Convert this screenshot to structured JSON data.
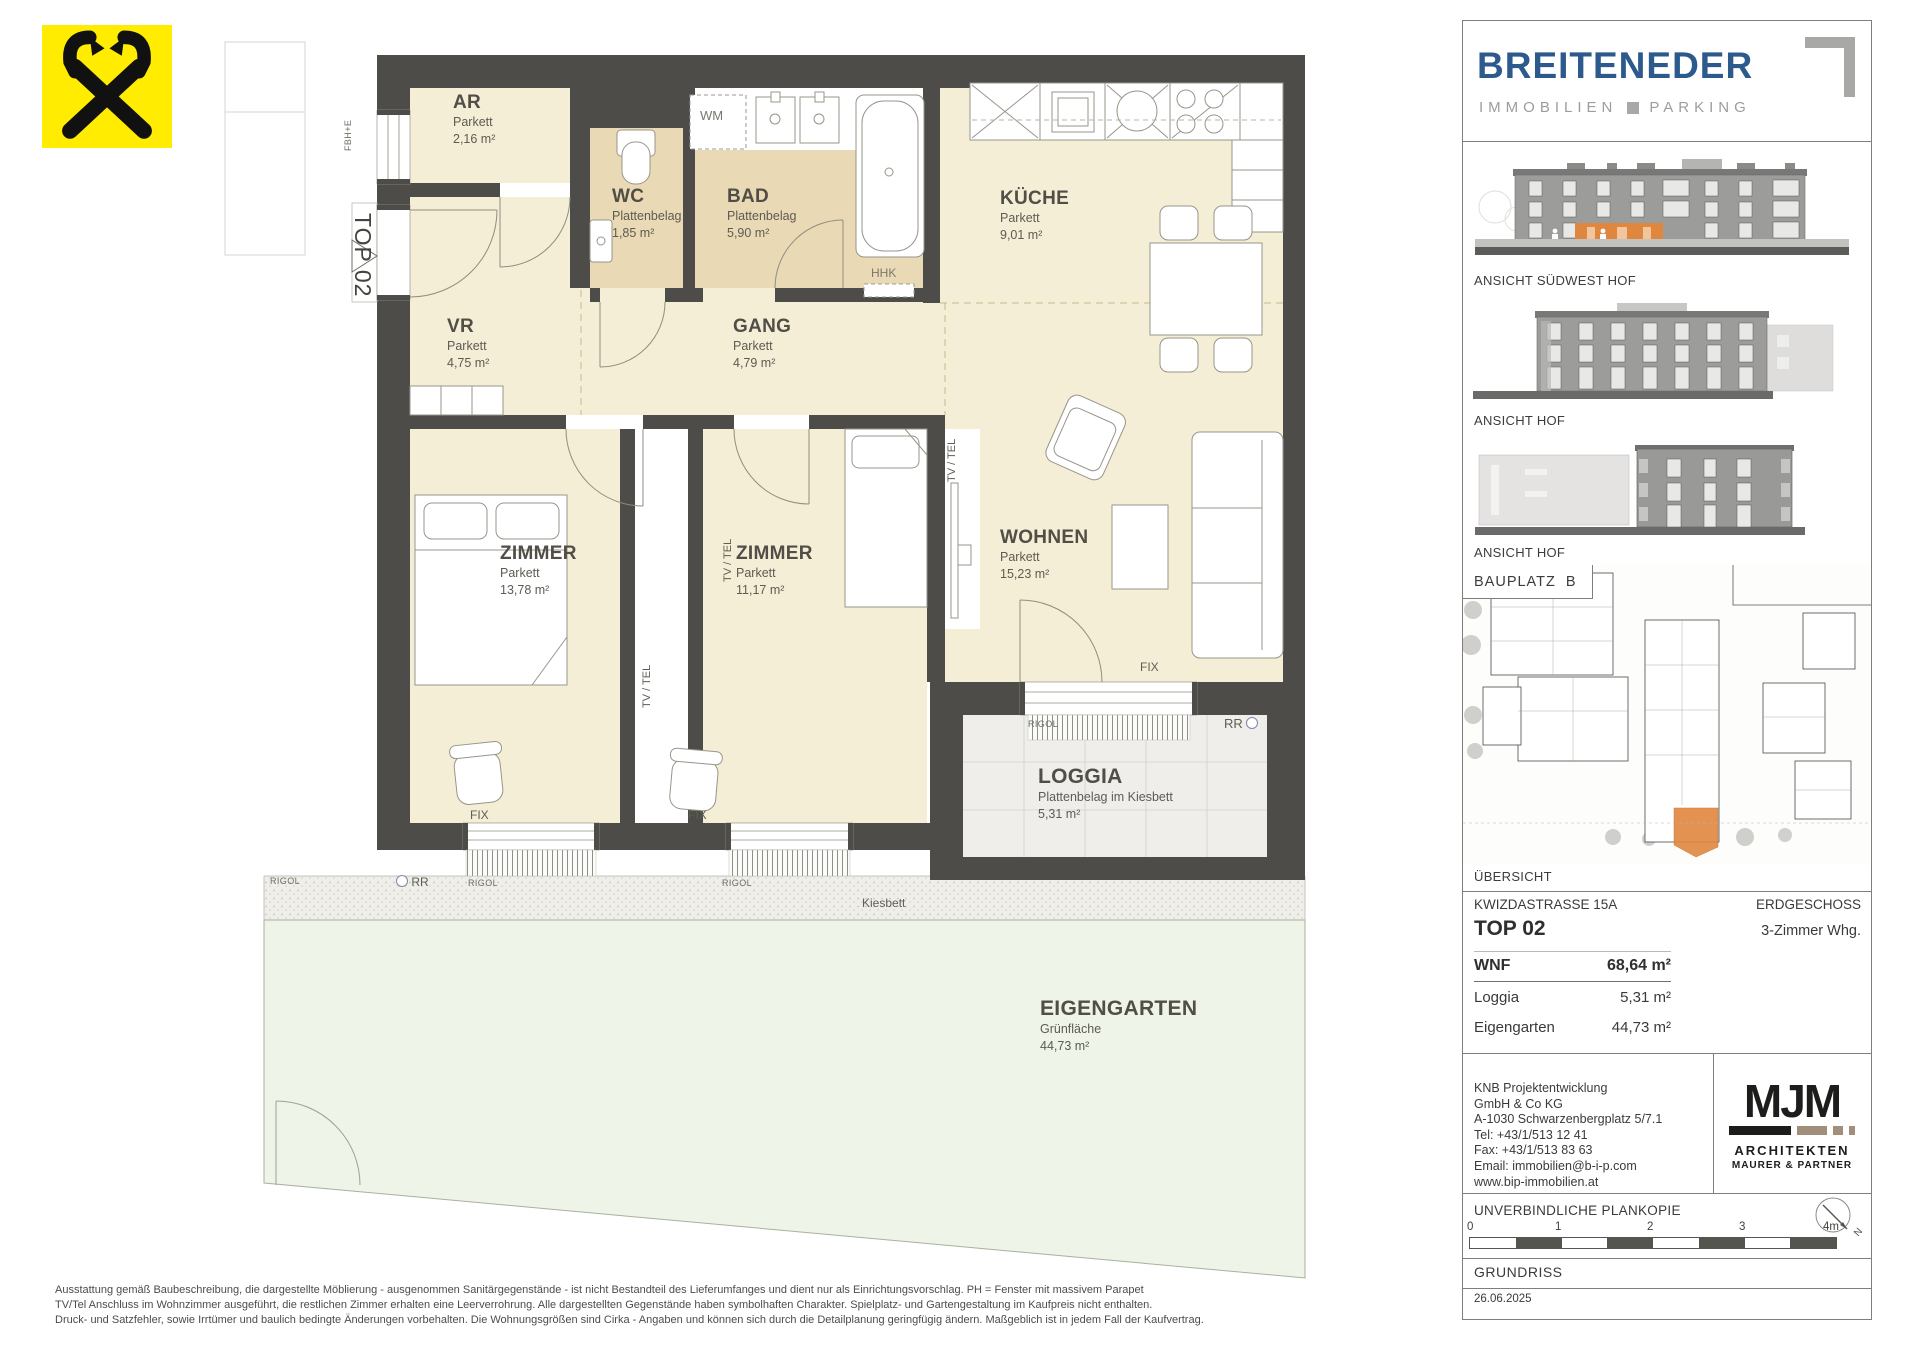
{
  "plan": {
    "unit_label": "TOP 02",
    "rooms": {
      "ar": {
        "name": "AR",
        "floor": "Parkett",
        "area": "2,16 m²"
      },
      "wc": {
        "name": "WC",
        "floor": "Plattenbelag",
        "area": "1,85 m²"
      },
      "bad": {
        "name": "BAD",
        "floor": "Plattenbelag",
        "area": "5,90 m²"
      },
      "kueche": {
        "name": "KÜCHE",
        "floor": "Parkett",
        "area": "9,01 m²"
      },
      "vr": {
        "name": "VR",
        "floor": "Parkett",
        "area": "4,75 m²"
      },
      "gang": {
        "name": "GANG",
        "floor": "Parkett",
        "area": "4,79 m²"
      },
      "zimmer1": {
        "name": "ZIMMER",
        "floor": "Parkett",
        "area": "13,78 m²"
      },
      "zimmer2": {
        "name": "ZIMMER",
        "floor": "Parkett",
        "area": "11,17 m²"
      },
      "wohnen": {
        "name": "WOHNEN",
        "floor": "Parkett",
        "area": "15,23 m²"
      },
      "loggia": {
        "name": "LOGGIA",
        "floor": "Plattenbelag im Kiesbett",
        "area": "5,31 m²"
      },
      "garten": {
        "name": "EIGENGARTEN",
        "floor": "Grünfläche",
        "area": "44,73 m²"
      }
    },
    "annotations": {
      "wm": "WM",
      "hhk": "HHK",
      "fix": "FIX",
      "rigol": "RIGOL",
      "rr": "RR",
      "kiesbett": "Kiesbett",
      "tv_tel": "TV / TEL",
      "fbhe": "FBH+E"
    }
  },
  "sidebar": {
    "brand": {
      "name": "BREITENEDER",
      "tagline_immobilien": "IMMOBILIEN",
      "tagline_parking": "PARKING"
    },
    "elevations": [
      {
        "caption": "ANSICHT SÜDWEST HOF"
      },
      {
        "caption": "ANSICHT HOF"
      },
      {
        "caption": "ANSICHT HOF"
      }
    ],
    "siteplan": {
      "label": "BAUPLATZ  B",
      "caption": "ÜBERSICHT"
    },
    "details": {
      "street": "KWIZDASTRASSE 15A",
      "floor": "ERDGESCHOSS",
      "unit": "TOP 02",
      "unit_type": "3-Zimmer Whg.",
      "rows": [
        {
          "label": "WNF",
          "value": "68,64 m²"
        },
        {
          "label": "Loggia",
          "value": "5,31 m²"
        },
        {
          "label": "Eigengarten",
          "value": "44,73 m²"
        }
      ]
    },
    "company": {
      "lines": [
        "KNB Projektentwicklung",
        "GmbH & Co KG",
        "A-1030 Schwarzenbergplatz 5/7.1",
        "Tel: +43/1/513 12 41",
        "Fax: +43/1/513 83 63",
        "Email: immobilien@b-i-p.com",
        "www.bip-immobilien.at"
      ]
    },
    "architect": {
      "wordmark": "MJM",
      "line1": "ARCHITEKTEN",
      "line2": "MAURER & PARTNER"
    },
    "footer": {
      "plankopie": "UNVERBINDLICHE PLANKOPIE",
      "scale_ticks": [
        "0",
        "1",
        "2",
        "3",
        "4m"
      ],
      "north_label": "N",
      "title": "GRUNDRISS",
      "date": "26.06.2025"
    }
  },
  "disclaimer": {
    "lines": [
      "Ausstattung gemäß Baubeschreibung, die dargestellte Möblierung - ausgenommen Sanitärgegenstände - ist nicht Bestandteil des Lieferumfanges und dient nur als Einrichtungsvorschlag. PH = Fenster mit massivem Parapet",
      "TV/Tel Anschluss im Wohnzimmer ausgeführt, die restlichen Zimmer erhalten eine Leerverrohrung. Alle dargestellten Gegenstände haben symbolhaften Charakter. Spielplatz- und Gartengestaltung im Kaufpreis nicht enthalten.",
      "Druck- und Satzfehler, sowie Irrtümer und baulich bedingte Änderungen vorbehalten. Die Wohnungsgrößen sind Cirka - Angaben und können sich durch die Detailplanung geringfügig ändern. Maßgeblich ist in jedem Fall der Kaufvertrag."
    ]
  },
  "colors": {
    "accent_orange": "#E0873F",
    "brand_blue": "#2D5A8D",
    "wall_gray": "#4D4C48",
    "floor_cream": "#F5EED6",
    "floor_tile": "#EAD9B5",
    "garden_green": "#EEF4E7",
    "logo_yellow": "#FFEC00"
  }
}
